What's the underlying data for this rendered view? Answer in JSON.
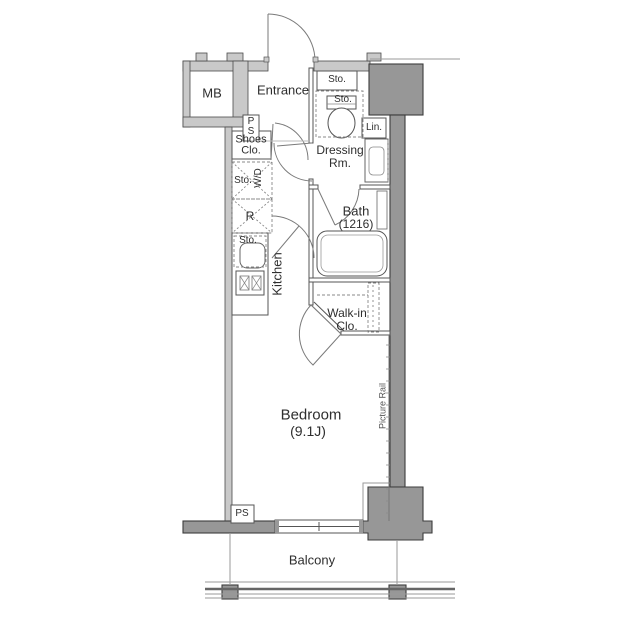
{
  "labels": {
    "mb": "MB",
    "entrance": "Entrance",
    "sto_entrance": "Sto.",
    "sto_toilet": "Sto.",
    "lin": "Lin.",
    "dressing_1": "Dressing",
    "dressing_2": "Rm.",
    "ps_top_1": "P",
    "ps_top_2": "S",
    "shoes_1": "Shoes",
    "shoes_2": "Clo.",
    "sto_wd": "Sto.",
    "wd": "W/D",
    "fridge": "R",
    "sto_kitchen": "Sto.",
    "kitchen": "Kitchen",
    "bath_1": "Bath",
    "bath_2": "(1216)",
    "walkin_1": "Walk-in",
    "walkin_2": "Clo.",
    "bedroom_1": "Bedroom",
    "bedroom_2": "(9.1J)",
    "picture_rail": "Picture Rail",
    "ps_bottom": "PS",
    "balcony": "Balcony"
  },
  "colors": {
    "wall_light": "#c9c9c9",
    "wall_dark": "#979797",
    "outline": "#4a4a4a",
    "partition": "#555555",
    "door_line": "#7a7a7a",
    "text": "#2e2e2e"
  }
}
